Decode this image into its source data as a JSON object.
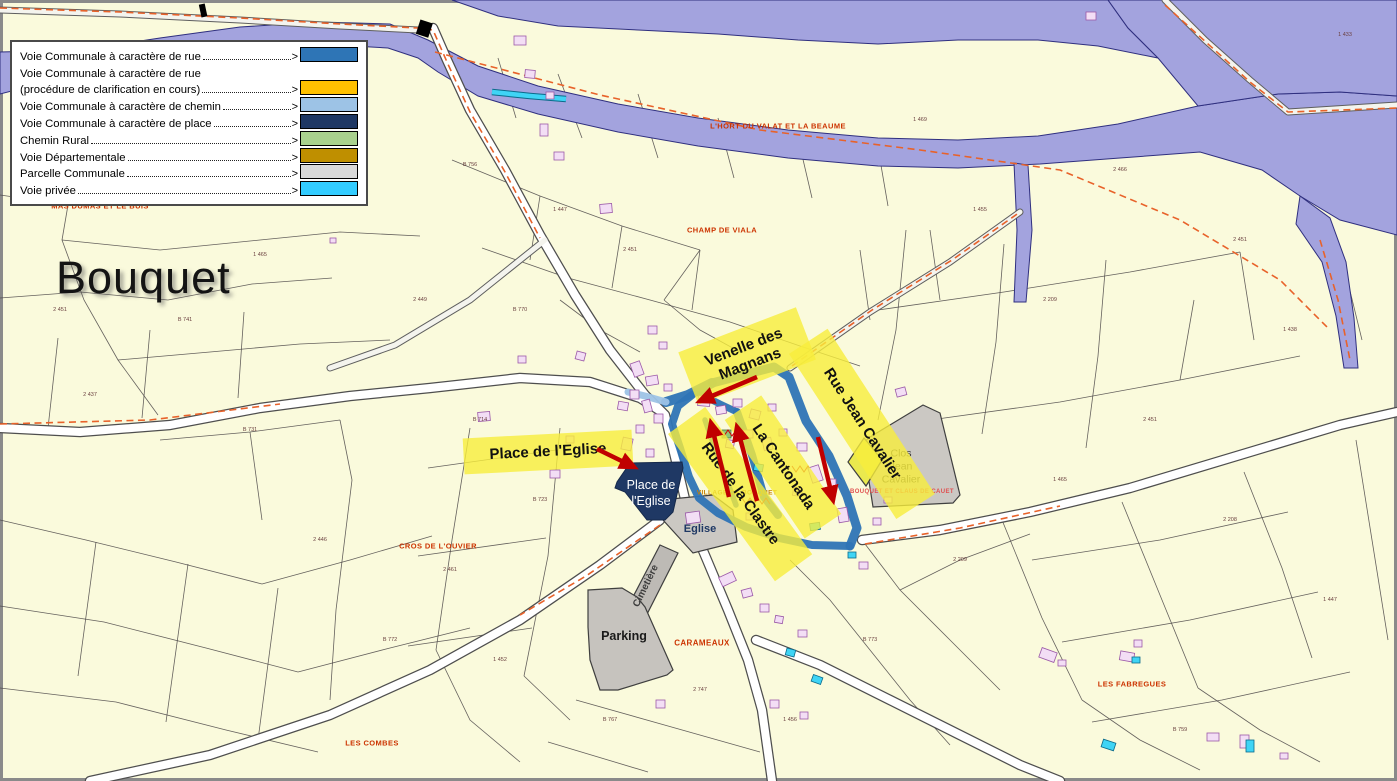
{
  "title": "Bouquet",
  "legend": {
    "gt": ">",
    "items": [
      {
        "label": "Voie Communale à caractère de rue",
        "color": "#2E75B6"
      },
      {
        "label": "Voie Communale à caractère de rue",
        "label2": "(procédure de clarification en cours)",
        "color": "#FFC000"
      },
      {
        "label": "Voie Communale à caractère de chemin",
        "color": "#9DC3E6"
      },
      {
        "label": "Voie Communale à caractère de place",
        "color": "#1F3864"
      },
      {
        "label": "Chemin Rural",
        "color": "#A9D18E"
      },
      {
        "label": "Voie Départementale",
        "color": "#BF8F00"
      },
      {
        "label": "Parcelle Communale",
        "color": "#D9D9D9"
      },
      {
        "label": "Voie privée",
        "color": "#33CCFF"
      }
    ]
  },
  "streets": {
    "venelle": {
      "line1": "Venelle des",
      "line2": "Magnans"
    },
    "cavalier": {
      "label": "Rue Jean Cavalier"
    },
    "clastre": {
      "label": "Rue de la Clastre"
    },
    "cantonada": {
      "label": "La Cantonada"
    },
    "place": {
      "label": "Place de l'Eglise"
    }
  },
  "places": {
    "place_square": {
      "line1": "Place de",
      "line2": "l'Eglise"
    },
    "eglise": "Eglise",
    "parking": "Parking",
    "cimetiere": "Cimetière",
    "clos": {
      "line1": "Clos",
      "line2": "Jean",
      "line3": "Cavalier"
    }
  },
  "localities": [
    {
      "text": "MAS DUMAS ET LE BUIS"
    },
    {
      "text": "L'HORT DU VALAT ET LA BEAUME"
    },
    {
      "text": "CHAMP DE VIALA"
    },
    {
      "text": "CROS DE L'OUVIER"
    },
    {
      "text": "CARAMEAUX"
    },
    {
      "text": "LES COMBES"
    },
    {
      "text": "LES FABREGUES"
    },
    {
      "text": "VILLAGE DE BOUQUET"
    },
    {
      "text": "BOUQUET ET CLAUS DE CAUET"
    }
  ],
  "parcel_numbers": [
    {
      "v": "2 456"
    },
    {
      "v": "1 433"
    },
    {
      "v": "2 451"
    },
    {
      "v": "B 741"
    },
    {
      "v": "2 437"
    },
    {
      "v": "1 465"
    },
    {
      "v": "2 433"
    },
    {
      "v": "B 756"
    },
    {
      "v": "1 447"
    },
    {
      "v": "2 451"
    },
    {
      "v": "B 770"
    },
    {
      "v": "2 449"
    },
    {
      "v": "B 714"
    },
    {
      "v": "B 723"
    },
    {
      "v": "2 461"
    },
    {
      "v": "B 772"
    },
    {
      "v": "1 452"
    },
    {
      "v": "B 767"
    },
    {
      "v": "2 747"
    },
    {
      "v": "1 456"
    },
    {
      "v": "B 773"
    },
    {
      "v": "2 209"
    },
    {
      "v": "1 465"
    },
    {
      "v": "2 451"
    },
    {
      "v": "2 209"
    },
    {
      "v": "1 455"
    },
    {
      "v": "2 466"
    },
    {
      "v": "2 451"
    },
    {
      "v": "1 438"
    },
    {
      "v": "2 208"
    },
    {
      "v": "1 447"
    },
    {
      "v": "B 759"
    },
    {
      "v": "1 469"
    },
    {
      "v": "1 433"
    },
    {
      "v": "B 731"
    },
    {
      "v": "2 446"
    }
  ],
  "colors": {
    "highlight": "#F7EE3C",
    "arrow": "#C00000",
    "river": "#A3A3DE",
    "village_road": "#2E74B5",
    "place_fill": "#1F3864",
    "boundary_dash": "#E8622A",
    "locality_text": "#CC3300"
  }
}
